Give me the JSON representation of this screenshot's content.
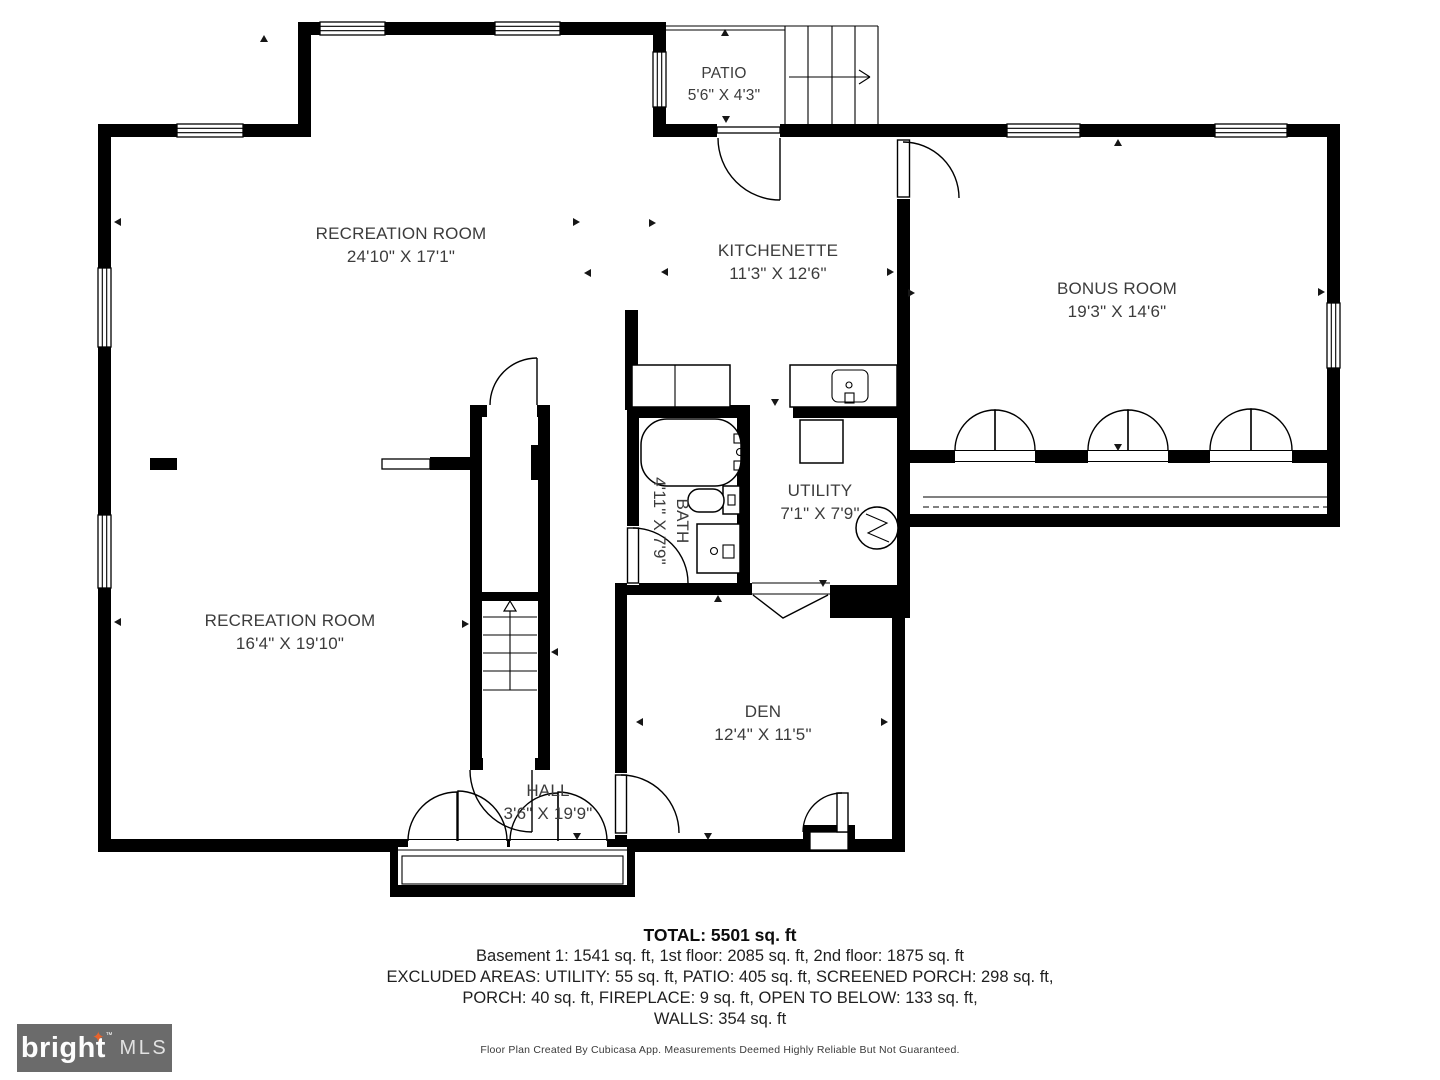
{
  "colors": {
    "wall": "#000000",
    "label_text": "#3c3c3c",
    "logo_bg": "#6b6b6b",
    "logo_star": "#e8632c"
  },
  "rooms": [
    {
      "id": "patio",
      "name": "PATIO",
      "dims": "5'6\" X 4'3\""
    },
    {
      "id": "recreation-room-upper",
      "name": "RECREATION ROOM",
      "dims": "24'10\" X 17'1\""
    },
    {
      "id": "kitchenette",
      "name": "KITCHENETTE",
      "dims": "11'3\" X 12'6\""
    },
    {
      "id": "bonus-room",
      "name": "BONUS ROOM",
      "dims": "19'3\" X 14'6\""
    },
    {
      "id": "bath",
      "name": "BATH",
      "dims": "4'11\" X 7'9\""
    },
    {
      "id": "utility",
      "name": "UTILITY",
      "dims": "7'1\" X 7'9\""
    },
    {
      "id": "recreation-room-lower",
      "name": "RECREATION ROOM",
      "dims": "16'4\" X 19'10\""
    },
    {
      "id": "den",
      "name": "DEN",
      "dims": "12'4\" X 11'5\""
    },
    {
      "id": "hall",
      "name": "HALL",
      "dims": "3'6\" X 19'9\""
    }
  ],
  "summary": {
    "total": "TOTAL: 5501 sq. ft",
    "line1": "Basement 1: 1541 sq. ft, 1st floor: 2085 sq. ft, 2nd floor: 1875 sq. ft",
    "line2": "EXCLUDED AREAS: UTILITY: 55 sq. ft, PATIO: 405 sq. ft, SCREENED PORCH: 298 sq. ft,",
    "line3": "PORCH: 40 sq. ft, FIREPLACE: 9 sq. ft, OPEN TO BELOW: 133 sq. ft,",
    "line4": "WALLS: 354 sq. ft"
  },
  "disclaimer": "Floor Plan Created By Cubicasa App. Measurements Deemed Highly Reliable But Not Guaranteed.",
  "logo": {
    "brand": "bright",
    "star": "✦",
    "tm": "™",
    "suffix": "MLS"
  }
}
